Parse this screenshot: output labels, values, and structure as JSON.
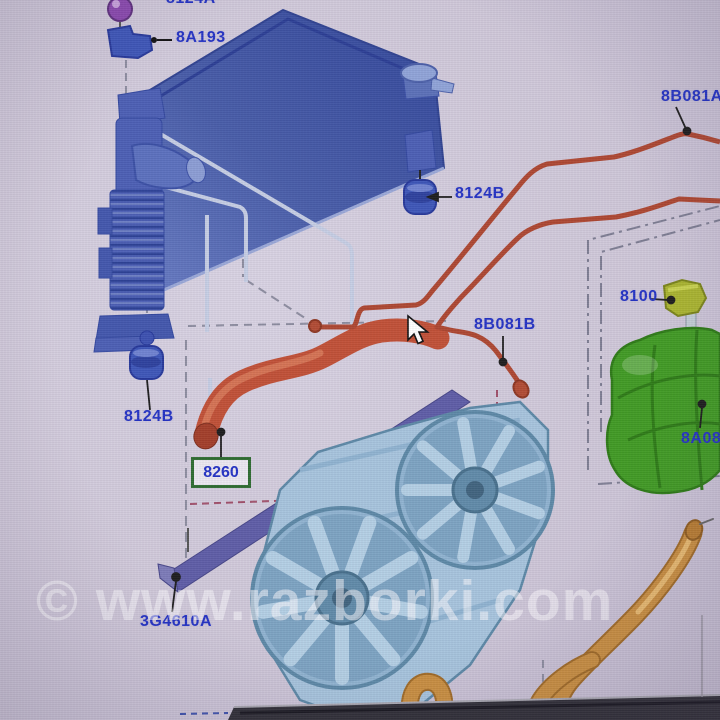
{
  "diagram": {
    "labels": {
      "mount_top": "8124A",
      "bracket": "8A193",
      "mount_right": "8124B",
      "mount_left": "8124B",
      "upper_hose": "8B081A",
      "bleed_hose": "8B081B",
      "tank_cap": "8100",
      "expansion_tank": "8A080",
      "lower_hose": "8260",
      "deflector": "3G4610A"
    },
    "selected_part": "8260",
    "colors": {
      "label_text": "#2231c4",
      "highlight_box": "#2d6b2f",
      "radiator_blue": "#41569f",
      "fan_blue": "#a6c4dd",
      "hose_red": "#b14a32",
      "thick_hose_red": "#c14f35",
      "tank_green": "#3f9a22",
      "cap_green": "#a9b42e",
      "hose_orange": "#c98e3f",
      "deflector_purple": "#5d5ca6",
      "mount_blue": "#3c55b8",
      "ball_purple": "#8a48ae"
    }
  },
  "watermark": {
    "text": "© www.razborki.com"
  }
}
